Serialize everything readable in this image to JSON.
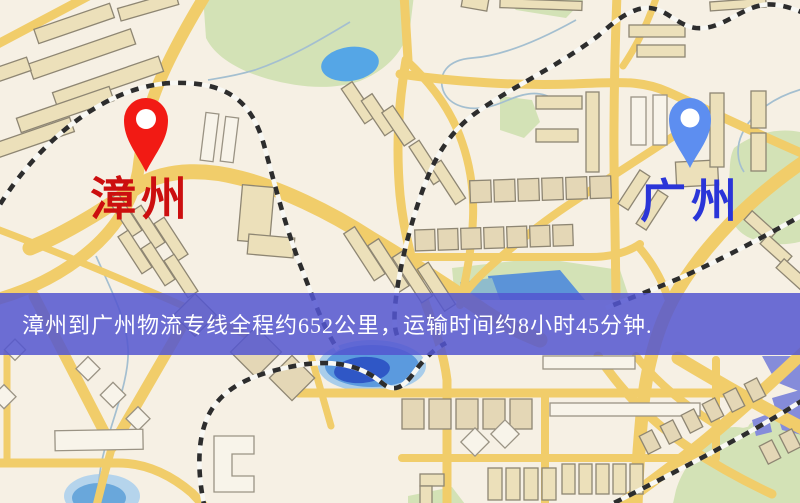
{
  "window": {
    "width": 800,
    "height": 503,
    "kind": "map-screenshot"
  },
  "map": {
    "type": "street-map",
    "markers": [
      {
        "id": "origin",
        "city": "漳州",
        "pin_color": "#f21a14",
        "label_color": "#cc0f0f",
        "icon": "location-pin-icon"
      },
      {
        "id": "destination",
        "city": "广州",
        "pin_color": "#5d8ef0",
        "label_color": "#2a35d8",
        "icon": "location-pin-icon"
      }
    ],
    "palette": {
      "background": "#f6f0e4",
      "road": "#f1cd6a",
      "building": "#ece0ba",
      "park": "#d3e2b6",
      "lake": "#55a6e6",
      "river_deep": "#2f57c6",
      "railway": "#2d2d2d",
      "banner": "#5456d0"
    }
  },
  "banner": {
    "text": "漳州到广州物流专线全程约652公里，运输时间约8小时45分钟.",
    "background": "#5456d0",
    "text_color": "#ffffff",
    "route": {
      "origin": "漳州",
      "destination": "广州",
      "service": "物流专线",
      "distance_text": "约652公里",
      "distance_km": 652,
      "duration_text": "约8小时45分钟"
    }
  }
}
